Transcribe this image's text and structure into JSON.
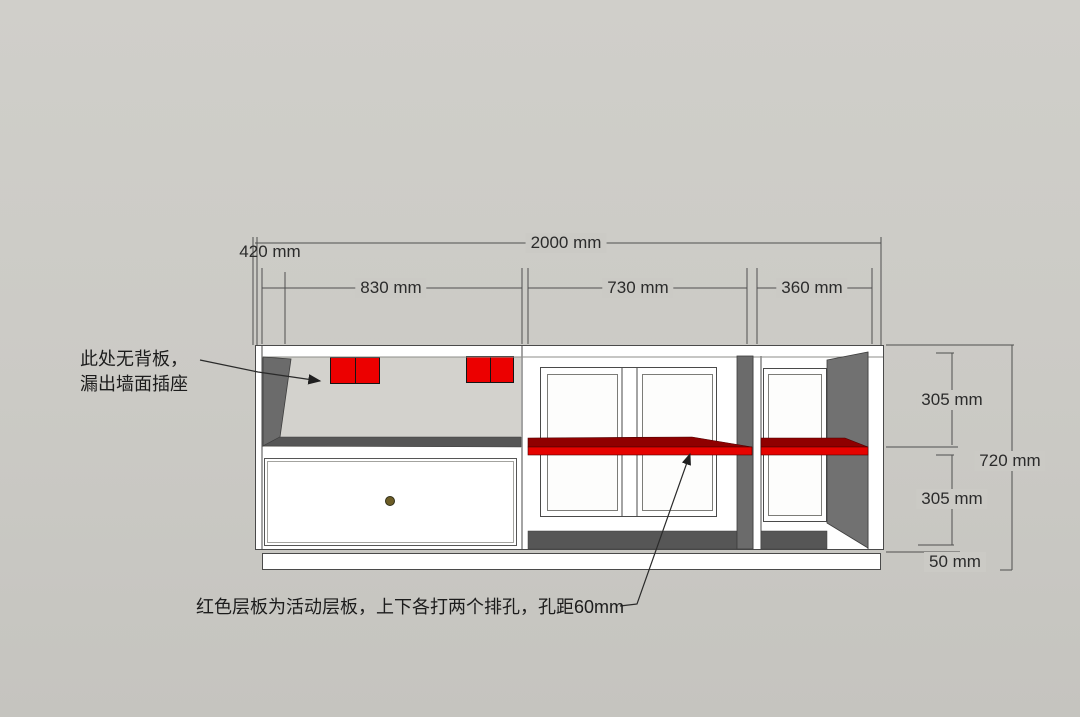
{
  "drawing": {
    "type": "cabinet-elevation-dimension-drawing",
    "dimensions": {
      "overall_width": "2000 mm",
      "depth": "420 mm",
      "left_section_width": "830 mm",
      "middle_section_width": "730 mm",
      "right_section_width": "360 mm",
      "upper_compartment_height": "305 mm",
      "lower_compartment_height": "305 mm",
      "overall_height": "720 mm",
      "plinth_height": "50 mm"
    },
    "annotations": {
      "no_back_panel_line1": "此处无背板，",
      "no_back_panel_line2": "漏出墙面插座",
      "shelf_note": "红色层板为活动层板，上下各打两个排孔，孔距60mm"
    },
    "colors": {
      "background": "#cbcac5",
      "cabinet_white": "#ffffff",
      "shelf_red_front": "#e60300",
      "shelf_red_top": "#8f0000",
      "outlet_red": "#ec0000",
      "side_panel_dark": "#6b6b6b",
      "floor_shadow": "#565656",
      "dimension_line": "#4f4f4f"
    }
  }
}
